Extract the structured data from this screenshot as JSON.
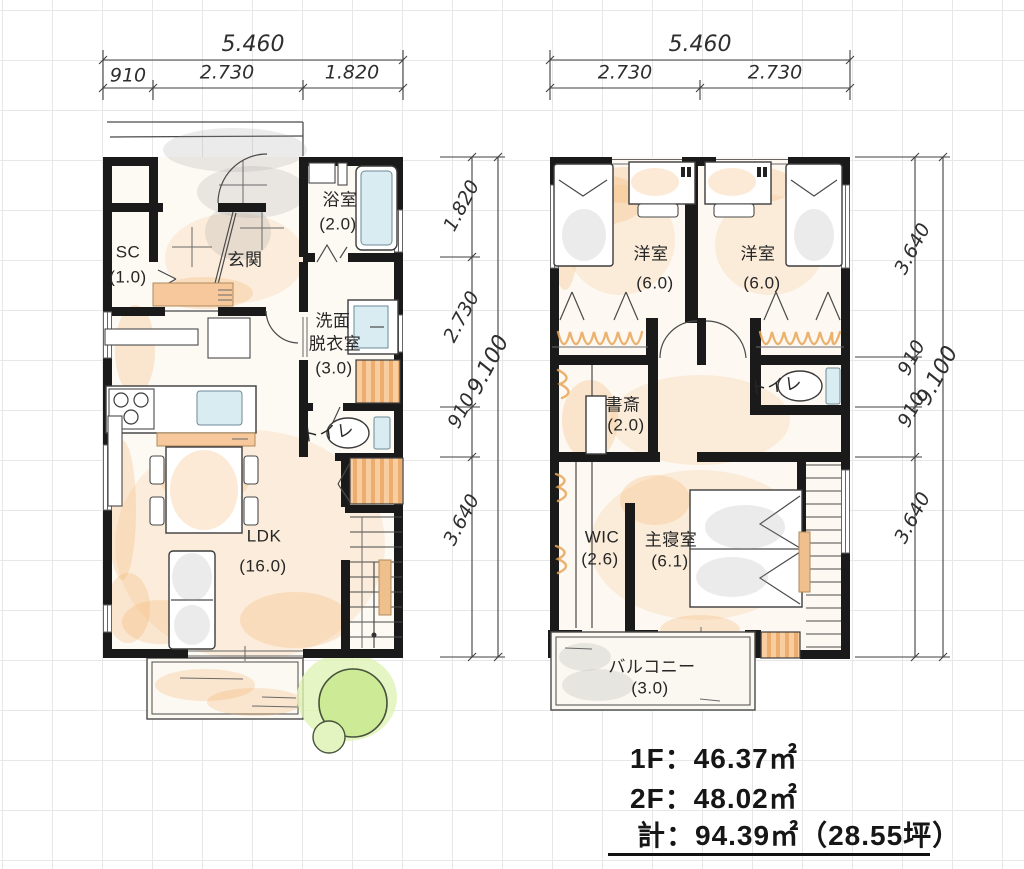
{
  "colors": {
    "wall": "#1a1a1a",
    "accent_orange": "#f3be8a",
    "accent_blue": "#d9ecf2",
    "accent_green": "#cdeb96",
    "accent_gray": "#d8d8d8"
  },
  "floor1": {
    "dim_top": {
      "total": "5.460",
      "segments": [
        "910",
        "2.730",
        "1.820"
      ]
    },
    "dim_side": {
      "total": "9.100",
      "segments": [
        "1.820",
        "2.730",
        "910",
        "3.640"
      ]
    },
    "rooms": {
      "bath": {
        "name": "浴室",
        "size": "(2.0)"
      },
      "shoe_closet": {
        "name": "SC",
        "size": "(1.0)"
      },
      "entrance": {
        "name": "玄関"
      },
      "washroom": {
        "line1": "洗面",
        "line2": "脱衣室",
        "line3": "(3.0)"
      },
      "toilet": {
        "name": "トイレ"
      },
      "ldk": {
        "name": "LDK",
        "size": "(16.0)"
      }
    }
  },
  "floor2": {
    "dim_top": {
      "total": "5.460",
      "segments": [
        "2.730",
        "2.730"
      ]
    },
    "dim_side": {
      "total": "9.100",
      "segments": [
        "3.640",
        "910",
        "910",
        "3.640"
      ]
    },
    "rooms": {
      "bedroom_left": {
        "name": "洋室",
        "size": "(6.0)"
      },
      "bedroom_right": {
        "name": "洋室",
        "size": "(6.0)"
      },
      "study": {
        "name": "書斎",
        "size": "(2.0)"
      },
      "toilet": {
        "name": "トイレ"
      },
      "wic": {
        "name": "WIC",
        "size": "(2.6)"
      },
      "master_bedroom": {
        "name": "主寝室",
        "size": "(6.1)"
      },
      "balcony": {
        "name": "バルコニー",
        "size": "(3.0)"
      }
    }
  },
  "area_summary": {
    "line1": "1F：46.37㎡",
    "line2": "2F：48.02㎡",
    "line3": "計：94.39㎡（28.55坪）"
  }
}
